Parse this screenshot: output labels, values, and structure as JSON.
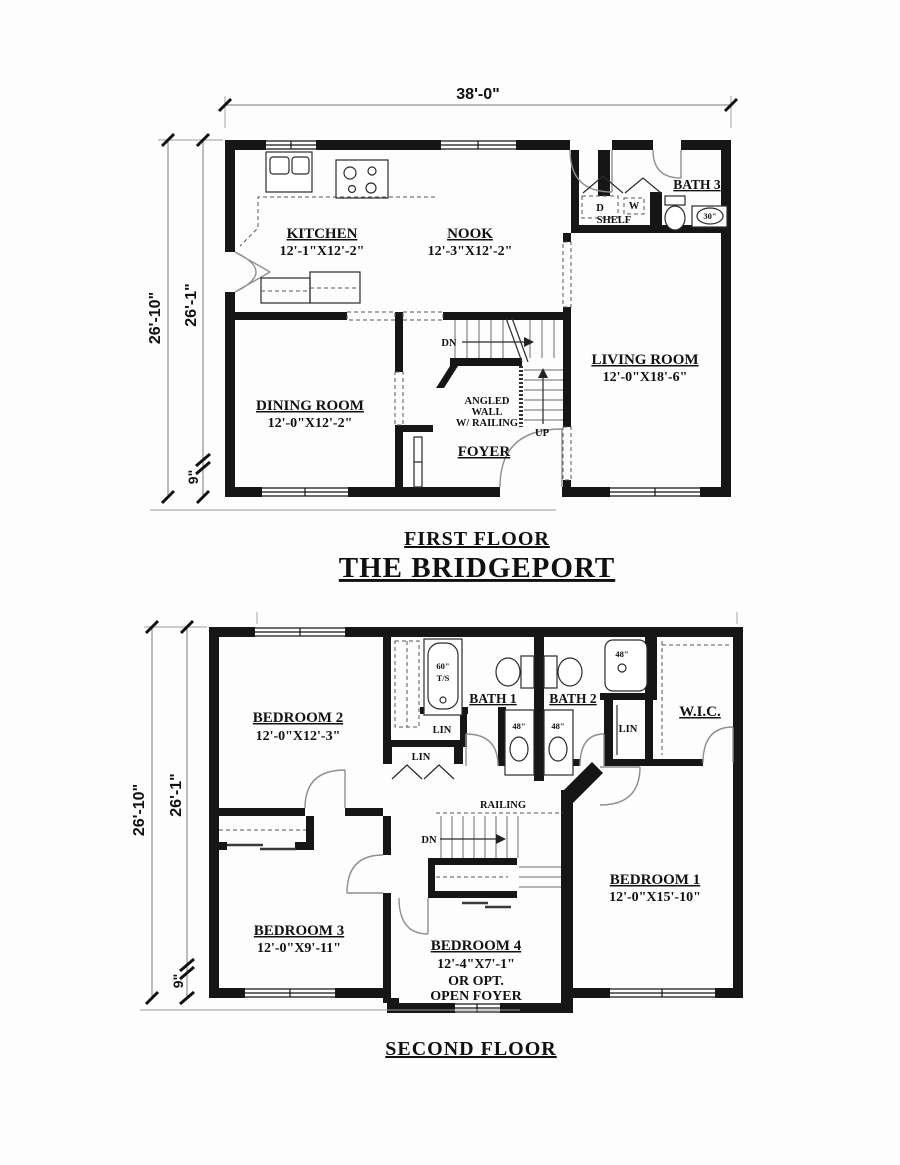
{
  "plan": {
    "name_title": "THE BRIDGEPORT",
    "first_floor": {
      "title": "FIRST FLOOR",
      "dims": {
        "width": "38'-0\"",
        "overall": "26'-10\"",
        "main": "26'-1\"",
        "offset": "9\""
      },
      "rooms": {
        "kitchen": {
          "name": "KITCHEN",
          "size": "12'-1\"X12'-2\""
        },
        "nook": {
          "name": "NOOK",
          "size": "12'-3\"X12'-2\""
        },
        "dining_room": {
          "name": "DINING ROOM",
          "size": "12'-0\"X12'-2\""
        },
        "living_room": {
          "name": "LIVING ROOM",
          "size": "12'-0\"X18'-6\""
        },
        "bath3": {
          "name": "BATH 3"
        },
        "foyer": {
          "name": "FOYER"
        }
      },
      "labels": {
        "down": "DN",
        "up": "UP",
        "dryer": "D",
        "washer": "W",
        "shelf": "SHELF",
        "vanity_size": "30\"",
        "angled_line1": "ANGLED",
        "angled_line2": "WALL",
        "angled_line3": "W/ RAILING"
      }
    },
    "second_floor": {
      "title": "SECOND FLOOR",
      "dims": {
        "overall": "26'-10\"",
        "main": "26'-1\"",
        "offset": "9\""
      },
      "rooms": {
        "bedroom1": {
          "name": "BEDROOM 1",
          "size": "12'-0\"X15'-10\""
        },
        "bedroom2": {
          "name": "BEDROOM 2",
          "size": "12'-0\"X12'-3\""
        },
        "bedroom3": {
          "name": "BEDROOM 3",
          "size": "12'-0\"X9'-11\""
        },
        "bedroom4": {
          "name": "BEDROOM 4",
          "size": "12'-4\"X7'-1\"",
          "alt_line1": "OR OPT.",
          "alt_line2": "OPEN FOYER"
        },
        "bath1": {
          "name": "BATH 1"
        },
        "bath2": {
          "name": "BATH 2"
        },
        "wic": {
          "name": "W.I.C."
        }
      },
      "labels": {
        "railing": "RAILING",
        "down": "DN",
        "linen": "LIN",
        "tub_size": "60\"",
        "tub_type": "T/S",
        "shower_size": "48\"",
        "vanity_size": "48\""
      }
    }
  }
}
